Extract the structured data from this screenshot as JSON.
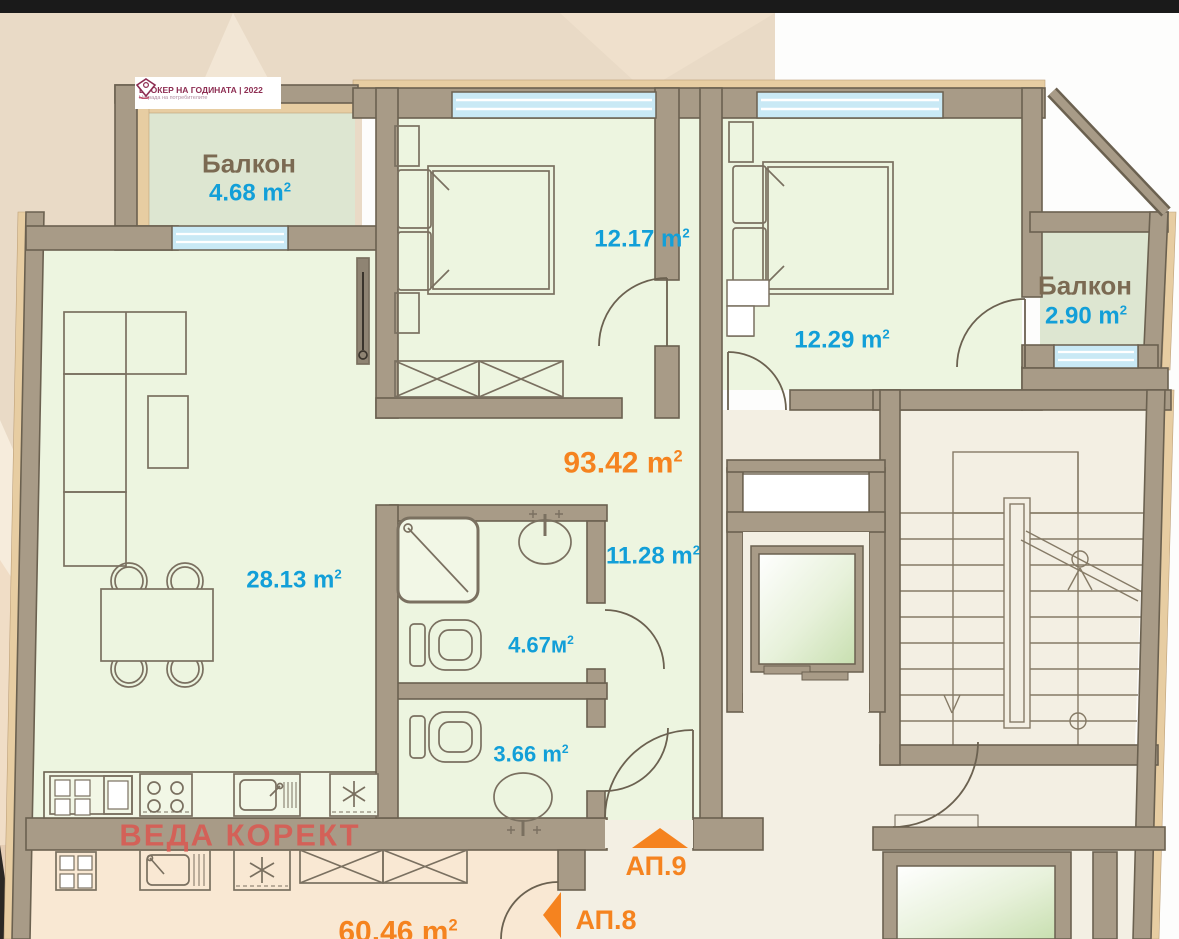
{
  "page": {
    "top_bar_color": "#1a1a1a",
    "background_color": "#ffffff"
  },
  "logo": {
    "title": "БРОКЕР НА ГОДИНАТА | 2022",
    "subtitle": "Награда на потребителите",
    "accent_color": "#8d2d52"
  },
  "watermark": {
    "text": "ВЕДА КОРЕКТ",
    "color": "#d95a52"
  },
  "palette": {
    "wall": "#a89b87",
    "wall_outline": "#6b6150",
    "insulation": "#e7cda2",
    "room_fill": "#edf5e0",
    "balcony_fill": "#dde6d1",
    "common_fill": "#f3efe3",
    "neighbor_fill": "#f9e8d3",
    "window_glass": "#c9e9f5",
    "area_text": "#129fd8",
    "room_title_text": "#7b6a52",
    "accent_orange": "#f5831f"
  },
  "apartment": {
    "total": {
      "text": "93.42 m",
      "sup": "2"
    },
    "rooms": {
      "balcony_left": {
        "title": "Балкон",
        "area": "4.68 m",
        "sup": "2"
      },
      "bedroom_1": {
        "area": "12.17 m",
        "sup": "2"
      },
      "bedroom_2": {
        "area": "12.29 m",
        "sup": "2"
      },
      "balcony_right": {
        "title": "Балкон",
        "area": "2.90 m",
        "sup": "2"
      },
      "living_room": {
        "area": "28.13 m",
        "sup": "2"
      },
      "hallway": {
        "area": "11.28 m",
        "sup": "2"
      },
      "bathroom": {
        "area": "4.67м",
        "sup": "2"
      },
      "wc": {
        "area": "3.66 m",
        "sup": "2"
      }
    },
    "neighbor": {
      "area": "60.46 m",
      "sup": "2"
    },
    "units": {
      "ap9": "АП.9",
      "ap8": "АП.8"
    }
  }
}
